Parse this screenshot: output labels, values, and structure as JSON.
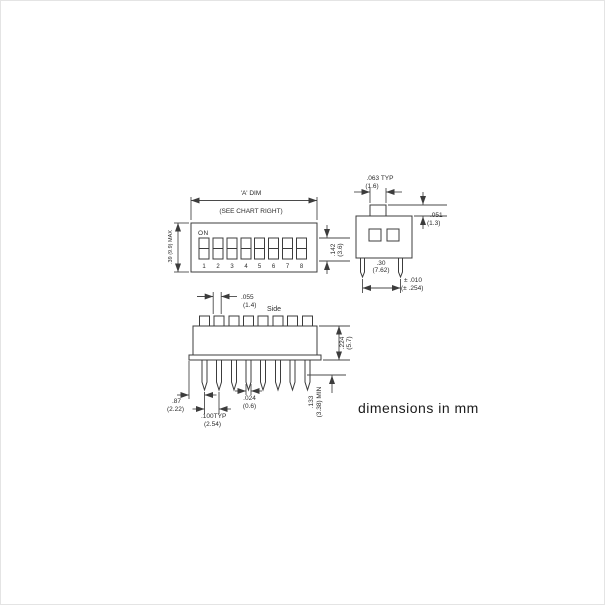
{
  "note": "dimensions in mm",
  "top_view": {
    "title_dim": "'A' DIM",
    "title_sub": "(SEE CHART RIGHT)",
    "on_label": "ON",
    "switch_numbers": [
      "1",
      "2",
      "3",
      "4",
      "5",
      "6",
      "7",
      "8"
    ],
    "height_dim": ".39 (9.9) MAX",
    "slot_dim_in": ".142",
    "slot_dim_mm": "(3.6)"
  },
  "end_view": {
    "actuator_width_in": ".063 TYP",
    "actuator_width_mm": "(1.6)",
    "actuator_height_in": ".051",
    "actuator_height_mm": "(1.3)",
    "row_spacing_in": ".30",
    "row_spacing_mm": "(7.62)",
    "tolerance_in": "± .010",
    "tolerance_mm": "(± .254)"
  },
  "side_view": {
    "view_label": "Side",
    "tab_width_in": ".055",
    "tab_width_mm": "(1.4)",
    "body_height_in": ".224",
    "body_height_mm": "(5.7)",
    "pin_length_in": ".133",
    "pin_length_mm": "(3.38) MIN",
    "edge_to_pin_in": ".87",
    "edge_to_pin_mm": "(2.22)",
    "pin_pitch_in": ".100TYP",
    "pin_pitch_mm": "(2.54)",
    "pin_width_in": ".024",
    "pin_width_mm": "(0.6)"
  }
}
